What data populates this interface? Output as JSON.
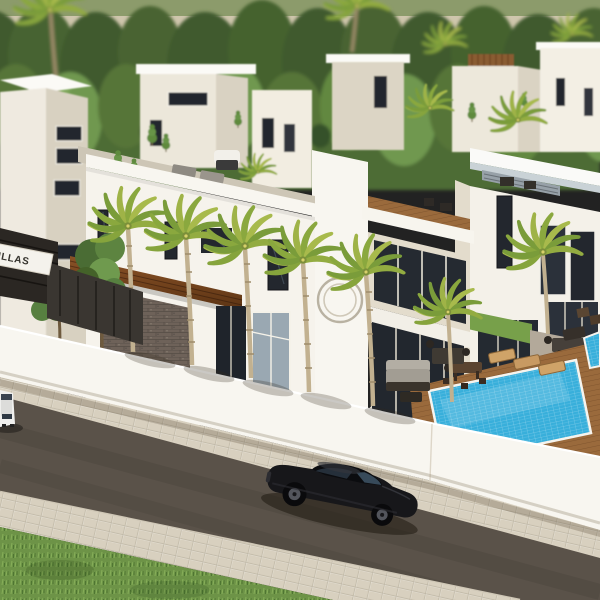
{
  "scene": {
    "type": "3d-architectural-render",
    "description": "Aerial rendering of a modern white villa development along a street with palm trees, swimming pools and a black sports car",
    "sign": {
      "text": "VILLAS"
    },
    "objects": [
      "tree-line",
      "background-buildings",
      "villa-a",
      "villa-b",
      "villa-c",
      "entrance-sign",
      "perimeter-wall",
      "street-palms",
      "swimming-pool",
      "second-pool",
      "sun-loungers",
      "outdoor-bar-set",
      "outdoor-sofa-set",
      "outdoor-dining-set",
      "roof-terraces",
      "sidewalk",
      "road",
      "grass-verge",
      "black-sports-car",
      "white-car"
    ]
  },
  "palette": {
    "sky-olive": "#8C9B6B",
    "horizon": "#CFC6AD",
    "tree-dark": "#3F5A2F",
    "tree-mid": "#567538",
    "tree-light": "#6F9850",
    "wall-white": "#F8F6F0",
    "face-shade": "#E3DCCC",
    "window-dark": "#23272E",
    "wood-beam": "#7A4A26",
    "deck-wood": "#9A6A3C",
    "stone": "#6E6259",
    "pavement": "#D8D0BF",
    "road": "#5A5249",
    "grass": "#6D9347",
    "pool-blue": "#38AFDB",
    "palm-frond": "#9FB347",
    "car-black": "#17171A"
  }
}
